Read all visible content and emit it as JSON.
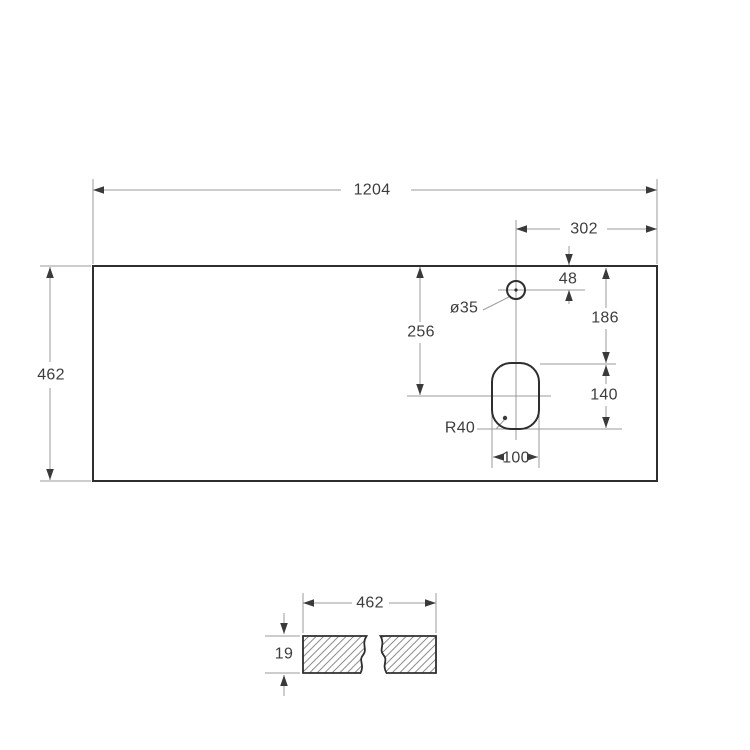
{
  "colors": {
    "outline": "#2e2e2e",
    "dimension_lines": "#9b9b9b",
    "text": "#3d3d3d",
    "arrows": "#3a3a3a",
    "hatch": "#8f8f8f",
    "background": "#ffffff"
  },
  "top_view": {
    "overall_width": "1204",
    "overall_depth": "462",
    "faucet_hole": {
      "diameter": "ø35",
      "offset_from_right": "302",
      "offset_from_top": "48"
    },
    "cutout": {
      "offset_from_top": "186",
      "center_offset_from_top": "256",
      "height": "140",
      "width": "100",
      "corner_radius": "R40"
    }
  },
  "section_view": {
    "width": "462",
    "thickness": "19"
  }
}
